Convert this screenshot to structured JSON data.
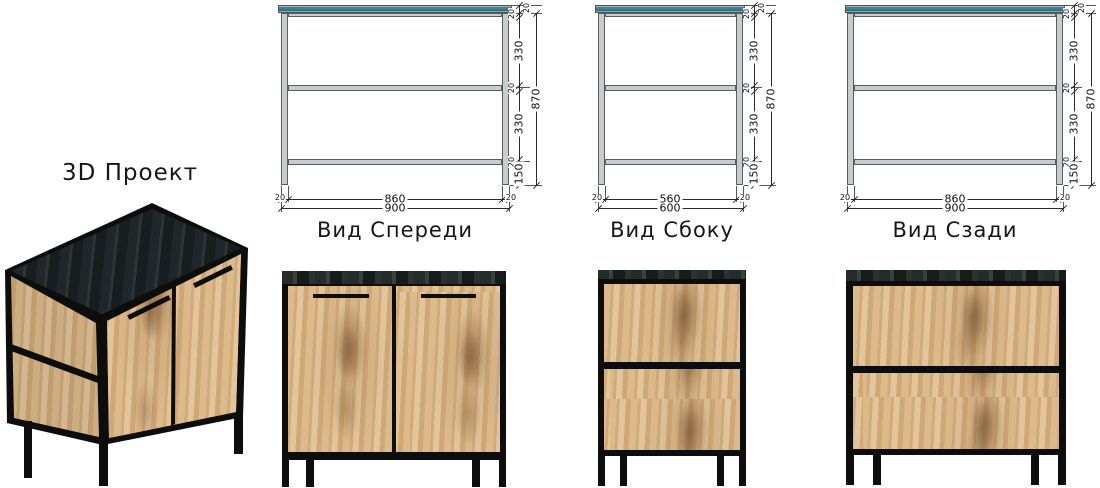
{
  "title_3d": "3D Проект",
  "drawings": {
    "front": {
      "label": "Вид Спереди",
      "width": {
        "inner": "860",
        "outer": "900",
        "left_end": "20",
        "right_end": "20"
      },
      "height": {
        "countertop": "20",
        "top_rail": "20",
        "upper": "330",
        "mid_rail": "20",
        "lower": "330",
        "bottom_rail": "20",
        "legs": "150",
        "total": "870"
      }
    },
    "side": {
      "label": "Вид Сбоку",
      "width": {
        "inner": "560",
        "outer": "600",
        "left_end": "20",
        "right_end": "20"
      },
      "height": {
        "countertop": "20",
        "top_rail": "20",
        "upper": "330",
        "mid_rail": "20",
        "lower": "330",
        "bottom_rail": "20",
        "legs": "150",
        "total": "870"
      }
    },
    "back": {
      "label": "Вид Сзади",
      "width": {
        "inner": "860",
        "outer": "900",
        "left_end": "20",
        "right_end": "20"
      },
      "height": {
        "countertop": "20",
        "top_rail": "20",
        "upper": "330",
        "mid_rail": "20",
        "lower": "330",
        "bottom_rail": "20",
        "legs": "150",
        "total": "870"
      }
    }
  },
  "colors": {
    "drawing_countertop_teal": "#3A8694",
    "drawing_frame_gray": "#C9CCCD",
    "dimension_line": "#2B2B2B",
    "metal_frame_black": "#0D0D0D",
    "wood_oak": "#D8B586",
    "stone_top_charcoal": "#222A2C",
    "background": "#FFFFFF"
  }
}
